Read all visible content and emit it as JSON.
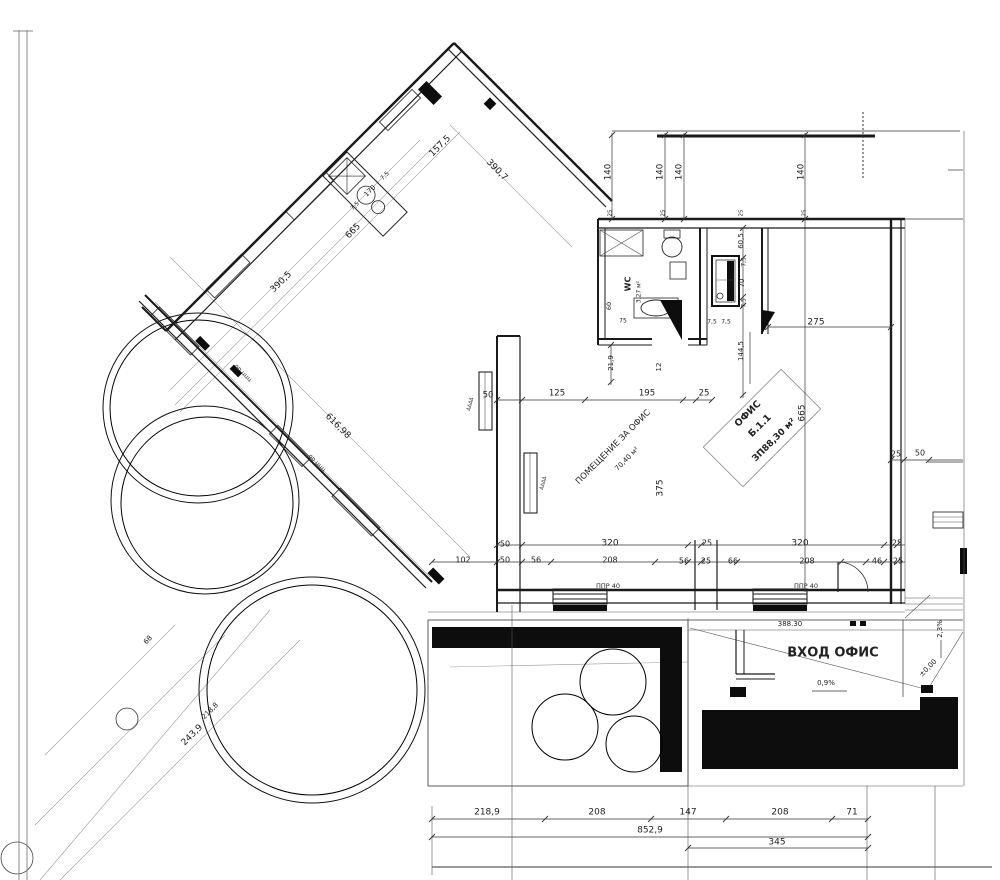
{
  "document": {
    "type": "architectural-floor-plan",
    "language": "bulgarian",
    "ink_color": "#1a1a1a",
    "paper_color": "#ffffff"
  },
  "rooms": [
    {
      "id": "office",
      "title": "ОФИС",
      "number": "Б.1.1",
      "area": "ЗП88,30 м²"
    },
    {
      "id": "office-hall",
      "title": "ПОМЕЩЕНИЕ ЗА ОФИС",
      "area": "70,40 м²"
    },
    {
      "id": "wc",
      "title": "WC",
      "area": "3,27 м²"
    }
  ],
  "entrance": {
    "label": "ВХОД ОФИС",
    "elevation": "388.30",
    "level": "±0,00",
    "slopes": [
      "0,9%",
      "2,3%"
    ]
  },
  "labels": [
    {
      "name": "dim-157-5",
      "t": "157,5",
      "x": 440,
      "y": 146,
      "r": -45,
      "s": 9
    },
    {
      "name": "dim-7-5-a",
      "t": "7,5",
      "x": 355,
      "y": 206,
      "r": -45,
      "s": 6
    },
    {
      "name": "dim-170",
      "t": "170",
      "x": 370,
      "y": 191,
      "r": -45,
      "s": 7
    },
    {
      "name": "dim-7-5-b",
      "t": "7,5",
      "x": 385,
      "y": 176,
      "r": -45,
      "s": 6
    },
    {
      "name": "dim-665-diagonal",
      "t": "665",
      "x": 353,
      "y": 231,
      "r": -45,
      "s": 9
    },
    {
      "name": "dim-390-5",
      "t": "390,5",
      "x": 281,
      "y": 282,
      "r": -45,
      "s": 9
    },
    {
      "name": "dim-390-7",
      "t": "390,7",
      "x": 497,
      "y": 170,
      "r": 45,
      "s": 9
    },
    {
      "name": "dim-616-98",
      "t": "616,98",
      "x": 338,
      "y": 426,
      "r": 45,
      "s": 9
    },
    {
      "name": "curb-note-a",
      "t": "ор ццц",
      "x": 243,
      "y": 373,
      "r": 45,
      "s": 6,
      "c": "#555"
    },
    {
      "name": "curb-note-b",
      "t": "ор ццц",
      "x": 317,
      "y": 463,
      "r": 45,
      "s": 6,
      "c": "#555"
    },
    {
      "name": "dim-243-9",
      "t": "243,9",
      "x": 192,
      "y": 735,
      "r": -45,
      "s": 9
    },
    {
      "name": "dim-218-8",
      "t": "218,8",
      "x": 210,
      "y": 711,
      "r": -45,
      "s": 7
    },
    {
      "name": "dim-68",
      "t": "68",
      "x": 148,
      "y": 640,
      "r": -45,
      "s": 7
    },
    {
      "name": "dim-140-1",
      "t": "140",
      "x": 608,
      "y": 172,
      "r": -90,
      "s": 8.5
    },
    {
      "name": "dim-140-2",
      "t": "140",
      "x": 660,
      "y": 172,
      "r": -90,
      "s": 8.5
    },
    {
      "name": "dim-140-3",
      "t": "140",
      "x": 679,
      "y": 172,
      "r": -90,
      "s": 8.5
    },
    {
      "name": "dim-140-4",
      "t": "140",
      "x": 801,
      "y": 172,
      "r": -90,
      "s": 8.5
    },
    {
      "name": "dim-25-w1",
      "t": "25",
      "x": 610,
      "y": 213,
      "r": -90,
      "s": 5.5
    },
    {
      "name": "dim-25-w2",
      "t": "25",
      "x": 663,
      "y": 213,
      "r": -90,
      "s": 5.5
    },
    {
      "name": "dim-25-w3",
      "t": "25",
      "x": 741,
      "y": 213,
      "r": -90,
      "s": 5.5
    },
    {
      "name": "dim-25-w4",
      "t": "25",
      "x": 804,
      "y": 213,
      "r": -90,
      "s": 5.5
    },
    {
      "name": "dim-60-5",
      "t": "60,5",
      "x": 741,
      "y": 241,
      "r": -90,
      "s": 7
    },
    {
      "name": "dim-7-5-c",
      "t": "7,5",
      "x": 744,
      "y": 262,
      "r": -90,
      "s": 6
    },
    {
      "name": "dim-70",
      "t": "70",
      "x": 742,
      "y": 283,
      "r": -90,
      "s": 7
    },
    {
      "name": "dim-7-5-d",
      "t": "7,5",
      "x": 744,
      "y": 303,
      "r": -90,
      "s": 6
    },
    {
      "name": "dim-144-5",
      "t": "144,5",
      "x": 741,
      "y": 351,
      "r": -90,
      "s": 7
    },
    {
      "name": "dim-7-5-e",
      "t": "7,5",
      "x": 712,
      "y": 322,
      "s": 6
    },
    {
      "name": "dim-7-5-f",
      "t": "7,5",
      "x": 726,
      "y": 322,
      "s": 6
    },
    {
      "name": "dim-275",
      "t": "275",
      "x": 816,
      "y": 322,
      "s": 9
    },
    {
      "name": "dim-665-right",
      "t": "665",
      "x": 802,
      "y": 413,
      "r": -90,
      "s": 9
    },
    {
      "name": "wc-title",
      "t": "WC",
      "x": 628,
      "y": 284,
      "r": -90,
      "s": 8,
      "b": true
    },
    {
      "name": "wc-area",
      "t": "3,27 м²",
      "x": 639,
      "y": 292,
      "r": -90,
      "s": 6
    },
    {
      "name": "dim-21-9",
      "t": "21,9",
      "x": 611,
      "y": 363,
      "r": -90,
      "s": 7
    },
    {
      "name": "dim-60",
      "t": "60",
      "x": 609,
      "y": 306,
      "r": -90,
      "s": 6.5
    },
    {
      "name": "dim-75",
      "t": "75",
      "x": 623,
      "y": 321,
      "s": 6
    },
    {
      "name": "dim-12",
      "t": "12",
      "x": 659,
      "y": 367,
      "r": -90,
      "s": 7
    },
    {
      "name": "dim-50-a",
      "t": "50",
      "x": 488,
      "y": 395,
      "s": 8.5
    },
    {
      "name": "dim-125",
      "t": "125",
      "x": 557,
      "y": 393,
      "s": 8.5
    },
    {
      "name": "dim-195",
      "t": "195",
      "x": 647,
      "y": 393,
      "s": 8.5
    },
    {
      "name": "dim-25-a",
      "t": "25",
      "x": 704,
      "y": 393,
      "s": 8.5
    },
    {
      "name": "room-office-hall-title",
      "t": "ПОМЕЩЕНИЕ ЗА ОФИС",
      "x": 613,
      "y": 447,
      "r": -45,
      "s": 8.5,
      "c": "#333"
    },
    {
      "name": "room-office-hall-area",
      "t": "70,40 м²",
      "x": 627,
      "y": 459,
      "r": -45,
      "s": 7,
      "c": "#333"
    },
    {
      "name": "room-office-title",
      "t": "ОФИС",
      "x": 748,
      "y": 414,
      "r": -45,
      "s": 9.5,
      "b": true
    },
    {
      "name": "room-office-number",
      "t": "Б.1.1",
      "x": 760,
      "y": 426,
      "r": -45,
      "s": 9.5,
      "b": true
    },
    {
      "name": "room-office-area",
      "t": "ЗП88,30 м²",
      "x": 774,
      "y": 440,
      "r": -45,
      "s": 9,
      "b": true
    },
    {
      "name": "dim-375",
      "t": "375",
      "x": 660,
      "y": 488,
      "r": -90,
      "s": 9
    },
    {
      "name": "dim-50-r1",
      "t": "50",
      "x": 505,
      "y": 544,
      "s": 8
    },
    {
      "name": "dim-320-1",
      "t": "320",
      "x": 610,
      "y": 543,
      "s": 9
    },
    {
      "name": "dim-25-r1",
      "t": "25",
      "x": 707,
      "y": 543,
      "s": 8
    },
    {
      "name": "dim-320-2",
      "t": "320",
      "x": 800,
      "y": 543,
      "s": 9
    },
    {
      "name": "dim-25-r2",
      "t": "25",
      "x": 897,
      "y": 543,
      "s": 8
    },
    {
      "name": "dim-102",
      "t": "102",
      "x": 463,
      "y": 560,
      "s": 8
    },
    {
      "name": "dim-50-r2",
      "t": "50",
      "x": 505,
      "y": 560,
      "s": 8
    },
    {
      "name": "dim-56-1",
      "t": "56",
      "x": 536,
      "y": 560,
      "s": 8
    },
    {
      "name": "dim-208-1",
      "t": "208",
      "x": 610,
      "y": 560,
      "s": 8
    },
    {
      "name": "dim-56-2",
      "t": "56",
      "x": 684,
      "y": 561,
      "s": 8
    },
    {
      "name": "dim-25-r3",
      "t": "25",
      "x": 706,
      "y": 561,
      "s": 8
    },
    {
      "name": "dim-66",
      "t": "66",
      "x": 733,
      "y": 561,
      "s": 8
    },
    {
      "name": "dim-208-2",
      "t": "208",
      "x": 807,
      "y": 561,
      "s": 8
    },
    {
      "name": "dim-46",
      "t": "46",
      "x": 877,
      "y": 561,
      "s": 8
    },
    {
      "name": "dim-25-r4",
      "t": "25",
      "x": 898,
      "y": 561,
      "s": 8
    },
    {
      "name": "note-ppr-40-a",
      "t": "ППР 40",
      "x": 608,
      "y": 586,
      "s": 6.5
    },
    {
      "name": "note-ppr-40-b",
      "t": "ППР 40",
      "x": 806,
      "y": 586,
      "s": 6.5
    },
    {
      "name": "dim-25-b",
      "t": "25",
      "x": 896,
      "y": 454,
      "s": 8
    },
    {
      "name": "dim-50-b",
      "t": "50",
      "x": 920,
      "y": 453,
      "s": 8
    },
    {
      "name": "elevation-388-30",
      "t": "388.30",
      "x": 790,
      "y": 624,
      "s": 7
    },
    {
      "name": "entrance-label",
      "t": "ВХОД ОФИС",
      "x": 833,
      "y": 653,
      "s": 13,
      "b": true
    },
    {
      "name": "slope-0-9",
      "t": "0,9%",
      "x": 826,
      "y": 683,
      "s": 7
    },
    {
      "name": "slope-2-3",
      "t": "2,3%",
      "x": 940,
      "y": 629,
      "r": -90,
      "s": 7
    },
    {
      "name": "level-0-00",
      "t": "±0,00",
      "x": 928,
      "y": 668,
      "r": -45,
      "s": 7
    },
    {
      "name": "dim-218-9",
      "t": "218,9",
      "x": 487,
      "y": 812,
      "s": 9
    },
    {
      "name": "dim-208-3",
      "t": "208",
      "x": 597,
      "y": 812,
      "s": 9
    },
    {
      "name": "dim-147",
      "t": "147",
      "x": 688,
      "y": 812,
      "s": 9
    },
    {
      "name": "dim-208-4",
      "t": "208",
      "x": 780,
      "y": 812,
      "s": 9
    },
    {
      "name": "dim-71",
      "t": "71",
      "x": 852,
      "y": 812,
      "s": 9
    },
    {
      "name": "dim-852-9",
      "t": "852,9",
      "x": 650,
      "y": 830,
      "s": 9
    },
    {
      "name": "dim-345",
      "t": "345",
      "x": 777,
      "y": 842,
      "s": 9
    },
    {
      "name": "radiator-marks-a",
      "t": "ΔΔΔΔ",
      "x": 470,
      "y": 404,
      "r": -75,
      "s": 5,
      "c": "#555"
    },
    {
      "name": "radiator-marks-b",
      "t": "ΔΔΔΔ",
      "x": 543,
      "y": 483,
      "r": -75,
      "s": 5,
      "c": "#555"
    }
  ]
}
